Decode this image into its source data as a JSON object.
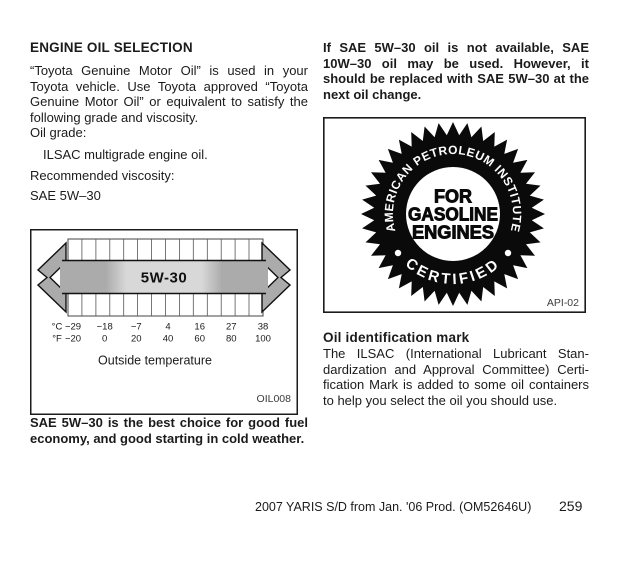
{
  "left_column": {
    "heading": "ENGINE OIL SELECTION",
    "intro": "“Toyota Genuine Motor Oil” is used in your Toyota vehicle. Use Toyota approved “Toyota Genuine Motor Oil” or equivalent to satisfy the following grade and viscos­ity.",
    "oil_grade_label": "Oil grade:",
    "oil_grade_value": "ILSAC multigrade engine oil.",
    "viscosity_label": "Recommended viscosity:",
    "viscosity_value": "SAE 5W–30",
    "note": "SAE 5W–30 is the best choice for good fuel economy, and good starting in cold weather."
  },
  "diagram": {
    "arrow_label": "5W-30",
    "celsius_prefix": "°C",
    "fahrenheit_prefix": "°F",
    "celsius": [
      "−29",
      "−18",
      "−7",
      "4",
      "16",
      "27",
      "38"
    ],
    "fahrenheit": [
      "−20",
      "0",
      "20",
      "40",
      "60",
      "80",
      "100"
    ],
    "caption": "Outside temperature",
    "figure_code": "OIL008"
  },
  "right_column": {
    "intro": "If SAE 5W–30 oil is not available, SAE 10W–30 oil may be used. However, it should be replaced with SAE 5W–30 at the next oil change.",
    "seal": {
      "top_text": "AMERICAN PETROLEUM INSTITUTE",
      "center_lines": [
        "FOR",
        "GASOLINE",
        "ENGINES"
      ],
      "bottom_text": "CERTIFIED",
      "figure_code": "API-02"
    },
    "heading": "Oil identification mark",
    "body": "The ILSAC (International Lubricant Stan­dardization and Approval Committee) Certi­fication Mark is added to some oil con­tainers to help you select the oil you should use."
  },
  "footer": {
    "text": "2007 YARIS S/D from Jan. '06 Prod. (OM52646U)",
    "page_number": "259"
  },
  "colors": {
    "text": "#1b1b1b",
    "seal": "#0a0a0a",
    "arrow_gray": "#ababab",
    "arrow_light": "#d8d8d8"
  }
}
